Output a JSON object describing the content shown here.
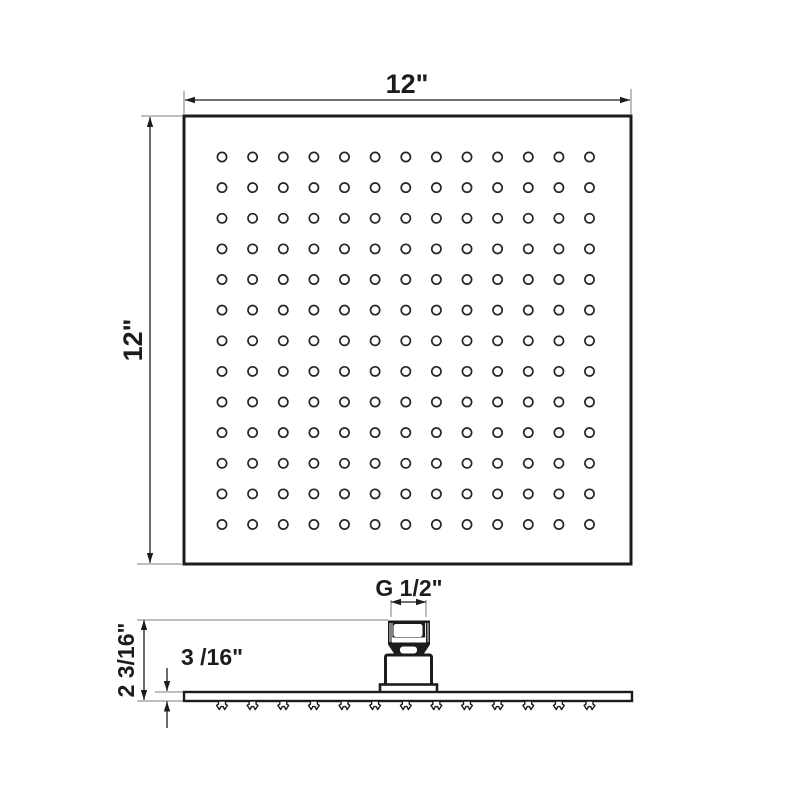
{
  "colors": {
    "background": "#ffffff",
    "line": "#1c1c1c",
    "extension_line": "#7d7d7d"
  },
  "top_view": {
    "width_label": "12\"",
    "height_label": "12\"",
    "hole_rows": 13,
    "hole_columns": 13
  },
  "side_view": {
    "thread_size_label": "G 1/2\"",
    "overall_height_label": "2 3/16\"",
    "plate_thickness_label": "3 /16\"",
    "nozzle_count": 13
  }
}
